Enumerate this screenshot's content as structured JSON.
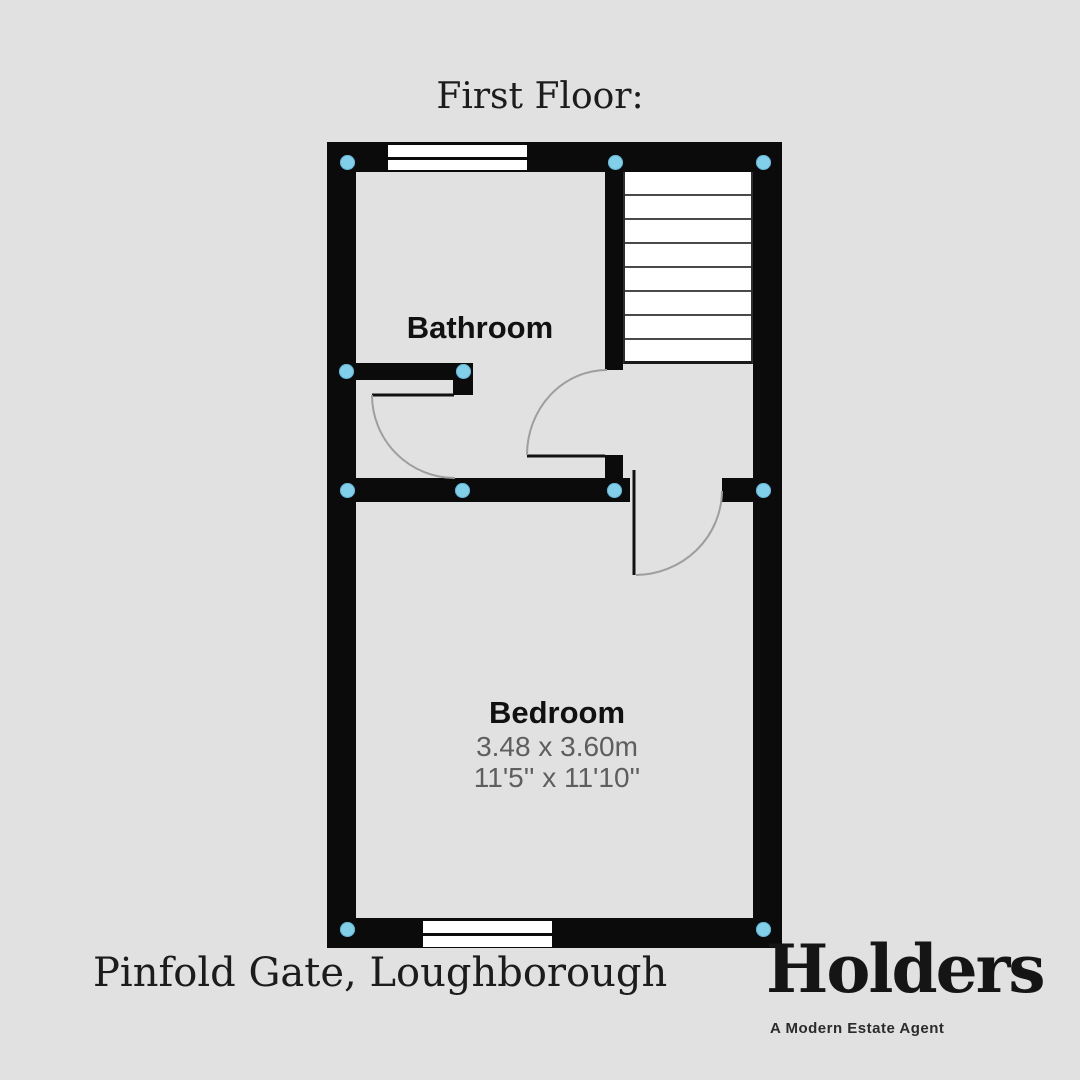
{
  "title": "First Floor:",
  "rooms": {
    "bathroom": {
      "label": "Bathroom"
    },
    "bedroom": {
      "label": "Bedroom",
      "size_metric": "3.48 x 3.60m",
      "size_imperial": "11'5'' x 11'10''"
    }
  },
  "address": "Pinfold Gate, Loughborough",
  "brand": {
    "name": "Holders",
    "tagline": "A Modern Estate Agent"
  },
  "colors": {
    "background": "#e1e1e1",
    "wall": "#0b0b0b",
    "corner_marker": "#82cfea",
    "dimension_text": "#5e5e5e"
  }
}
